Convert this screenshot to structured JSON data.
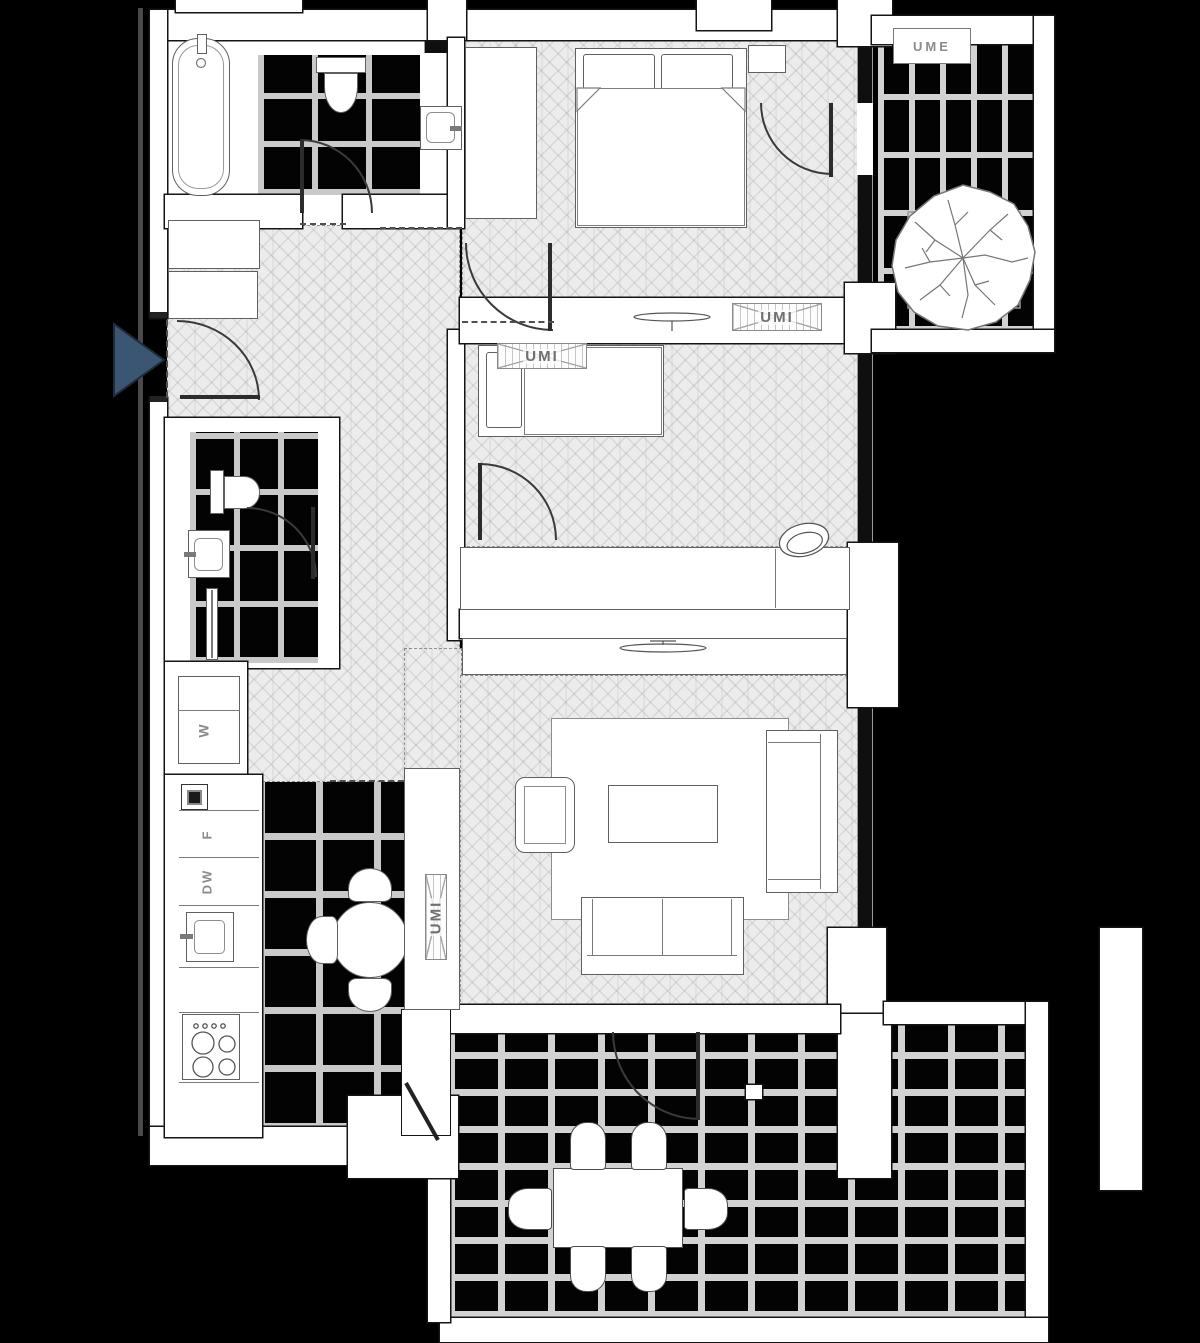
{
  "labels": {
    "ume": "UME",
    "umi": "UMI",
    "washer": "W",
    "fridge": "F",
    "dishwasher": "DW"
  },
  "colors": {
    "background": "#000000",
    "wall_fill": "#ffffff",
    "wall_line": "#141414",
    "wood_floor": "#ececec",
    "dark_tile": "#030303",
    "grout": "#c9c9c9",
    "glazing": "#0f0f0f",
    "entry_arrow": "#3a5673",
    "label_gray": "#8b8b8b"
  }
}
